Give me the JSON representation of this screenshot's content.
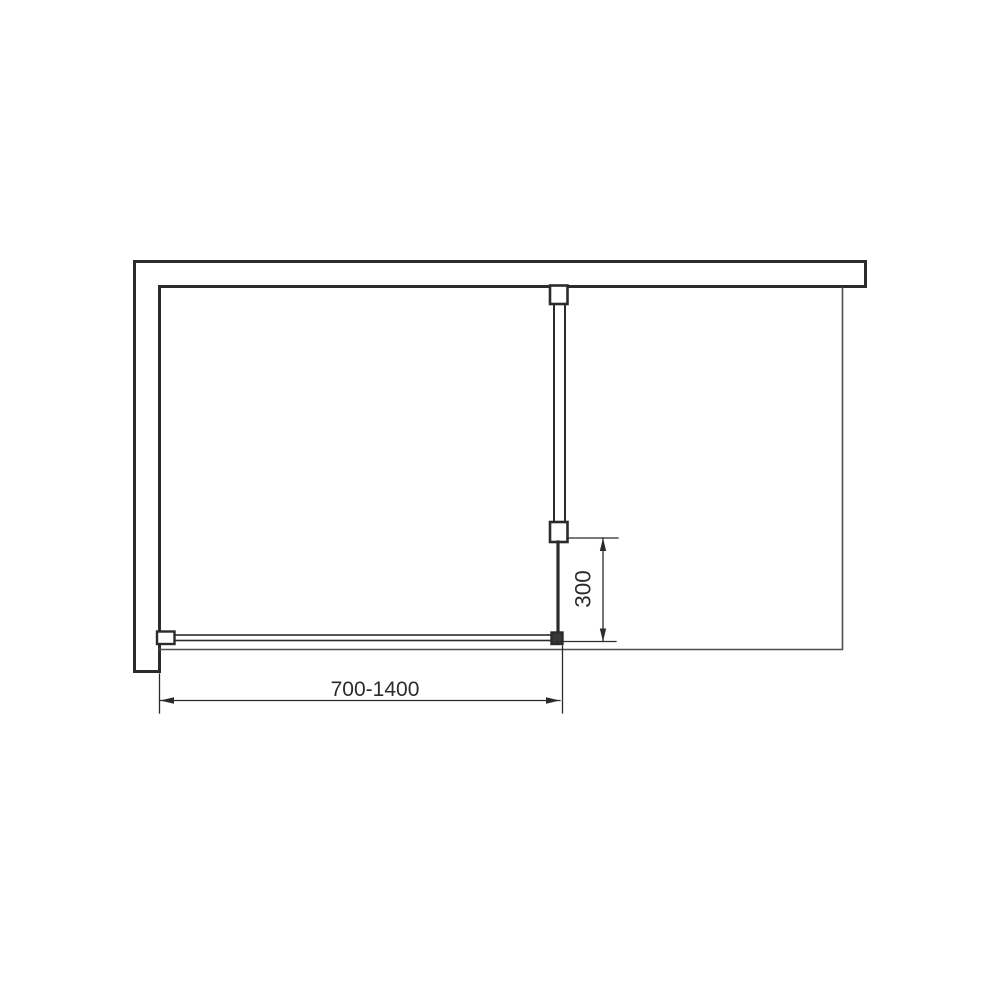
{
  "diagram": {
    "title": "walk-in shower screen plan view technical drawing",
    "dimensions": {
      "width": {
        "label": "700-1400",
        "unit": "mm",
        "min": 700,
        "max": 1400
      },
      "depth": {
        "label": "300",
        "unit": "mm",
        "value": 300
      }
    },
    "colors": {
      "line": "#2b2b2b",
      "thin_line": "#4f4f4f",
      "text": "#2b2b2b",
      "background": "#ffffff"
    }
  }
}
